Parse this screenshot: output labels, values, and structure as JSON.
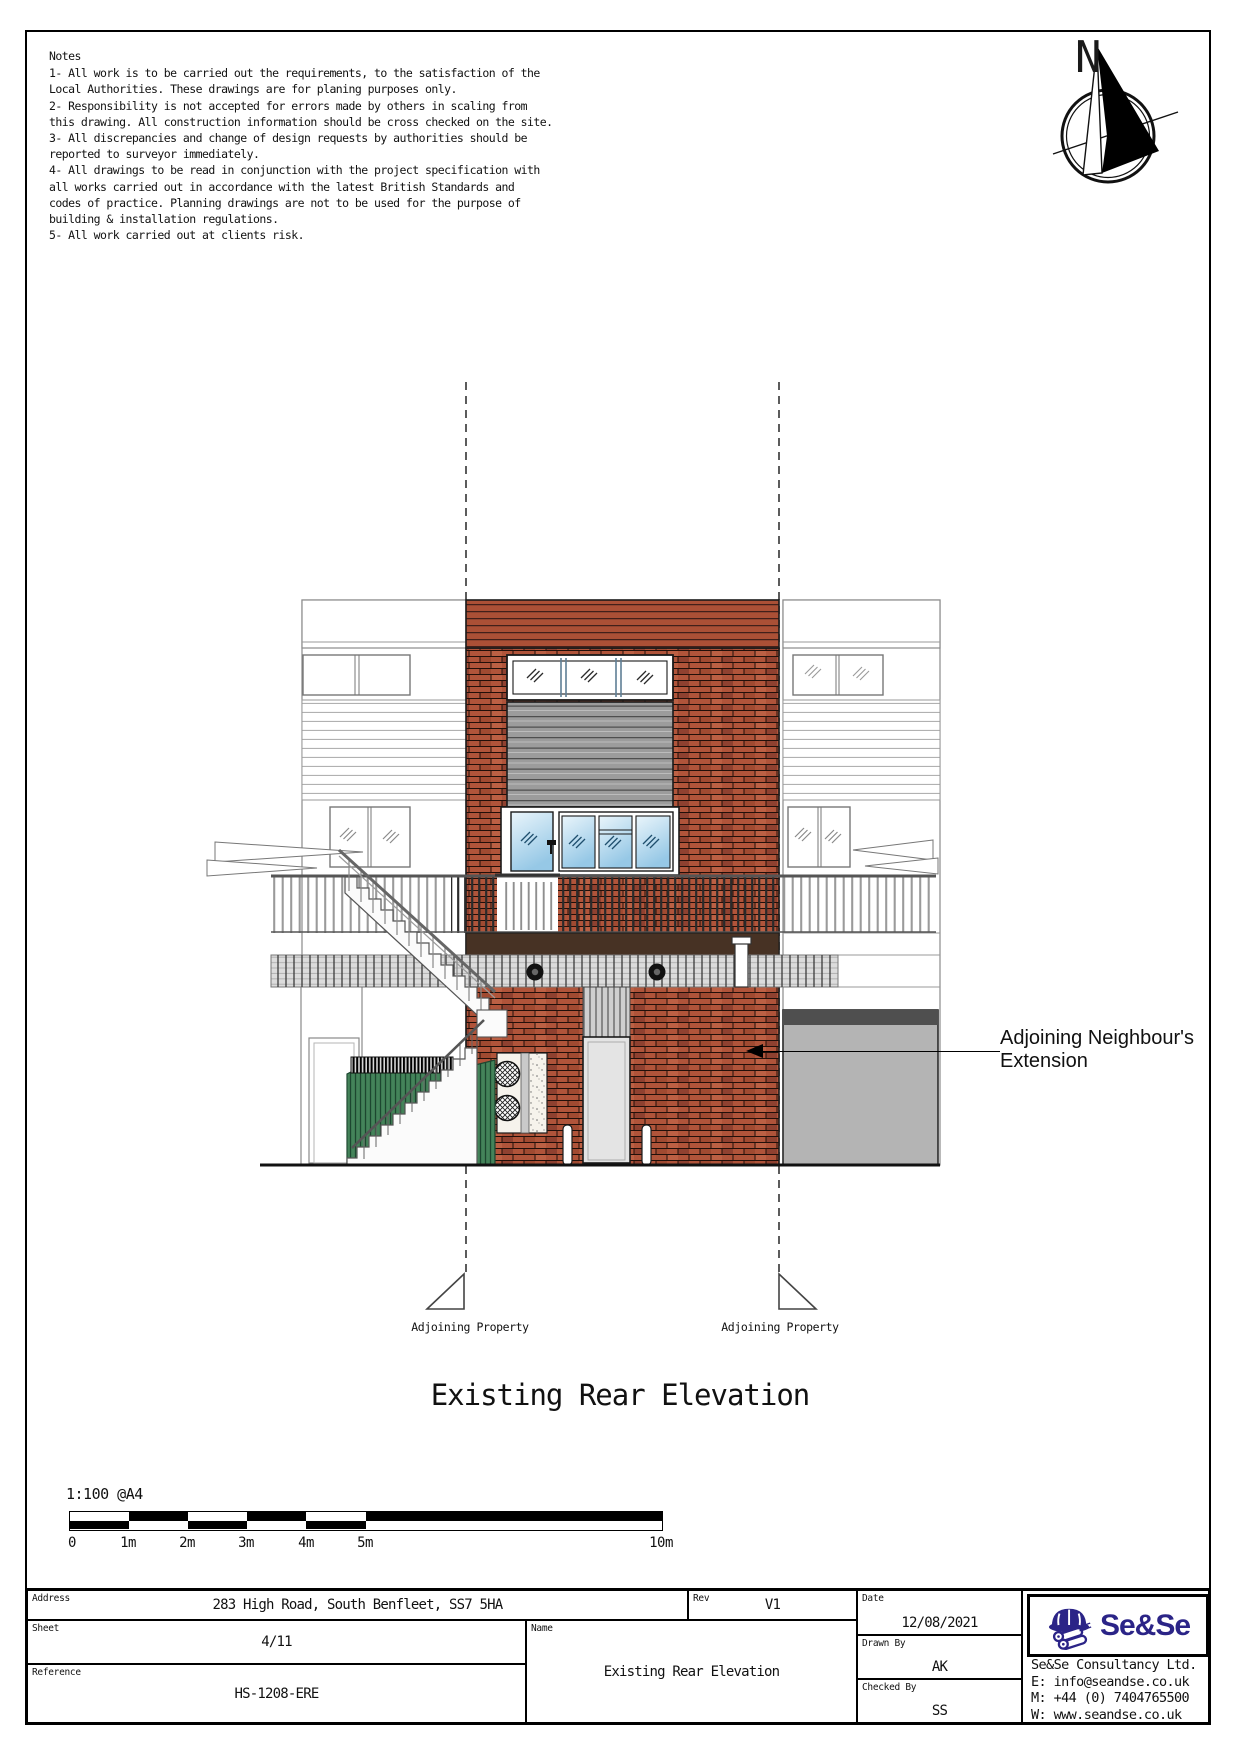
{
  "notes": {
    "heading": "Notes",
    "lines": [
      "1- All work is to be carried out the requirements, to the satisfaction of the",
      "Local Authorities. These drawings are for planing purposes only.",
      "2- Responsibility is not accepted for errors made by others in scaling from",
      "this drawing. All construction information should be cross checked on the site.",
      "3- All discrepancies and change of design requests by authorities should be",
      "reported to surveyor immediately.",
      "4- All drawings to be read in conjunction with the project specification with",
      "all works carried out in accordance with the latest British Standards and",
      "codes of practice. Planning drawings are not to be used for the purpose of",
      "building & installation regulations.",
      "5- All work carried out at clients risk."
    ]
  },
  "compass": {
    "north_label": "N"
  },
  "drawing": {
    "title": "Existing Rear Elevation",
    "extension_annotation": {
      "line1": "Adjoining Neighbour's",
      "line2": "Extension"
    },
    "boundary_left_label": "Adjoining Property",
    "boundary_right_label": "Adjoining Property",
    "colors": {
      "brick": "#b0543a",
      "roof_cladding": "#ab5036",
      "shutter_gray": "#9c9c9c",
      "glass_blue": "#a9d2ea",
      "fence_green": "#3e7c53",
      "fascia_brown": "#473224",
      "extension_gray": "#b4b4b4",
      "extension_roof": "#4f4f4f"
    }
  },
  "scale_bar": {
    "ratio": "1:100 @A4",
    "ticks": [
      "0",
      "1m",
      "2m",
      "3m",
      "4m",
      "5m",
      "10m"
    ]
  },
  "title_block": {
    "address": {
      "label": "Address",
      "value": "283 High Road, South Benfleet, SS7 5HA"
    },
    "sheet": {
      "label": "Sheet",
      "value": "4/11"
    },
    "reference": {
      "label": "Reference",
      "value": "HS-1208-ERE"
    },
    "rev": {
      "label": "Rev",
      "value": "V1"
    },
    "name": {
      "label": "Name",
      "value": "Existing Rear Elevation"
    },
    "date": {
      "label": "Date",
      "value": "12/08/2021"
    },
    "drawn_by": {
      "label": "Drawn By",
      "value": "AK"
    },
    "checked_by": {
      "label": "Checked By",
      "value": "SS"
    },
    "company": {
      "logo_text": "Se&Se",
      "logo_color": "#2b2487",
      "name": "Se&Se Consultancy Ltd.",
      "email": "E: info@seandse.co.uk",
      "mobile": "M: +44 (0) 7404765500",
      "web": "W: www.seandse.co.uk"
    }
  }
}
